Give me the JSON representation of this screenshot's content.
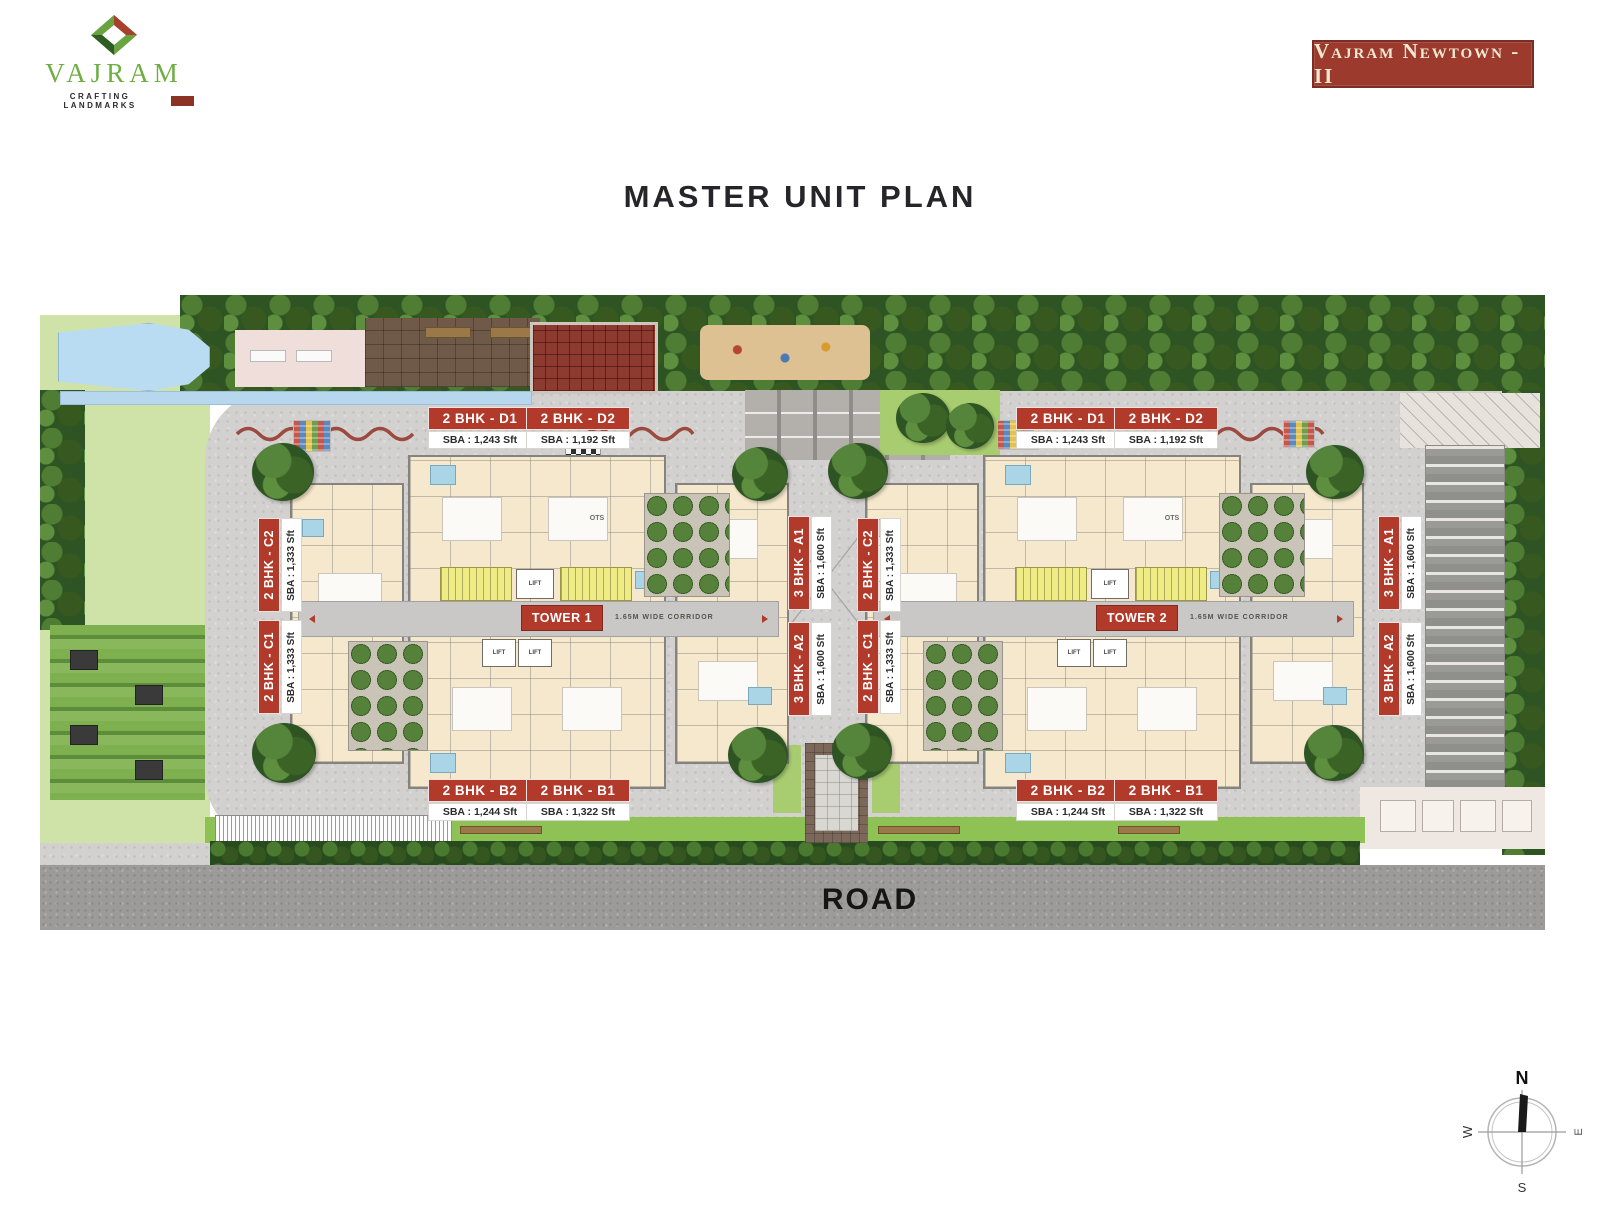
{
  "brand": {
    "name": "VAJRAM",
    "tagline": "CRAFTING LANDMARKS",
    "badge": "Vajram Newtown -II"
  },
  "title": "MASTER UNIT PLAN",
  "plan": {
    "towers": [
      {
        "name": "TOWER 1",
        "corridor": "1.65M WIDE CORRIDOR",
        "ots": "OTS",
        "lift": "LIFT",
        "units": {
          "top": [
            {
              "label": "2 BHK - D1",
              "sba": "SBA : 1,243 Sft"
            },
            {
              "label": "2 BHK - D2",
              "sba": "SBA : 1,192 Sft"
            }
          ],
          "bottom": [
            {
              "label": "2 BHK - B2",
              "sba": "SBA : 1,244 Sft"
            },
            {
              "label": "2 BHK - B1",
              "sba": "SBA : 1,322 Sft"
            }
          ],
          "left": [
            {
              "label": "2 BHK - C2",
              "sba": "SBA : 1,333 Sft"
            },
            {
              "label": "2 BHK - C1",
              "sba": "SBA : 1,333 Sft"
            }
          ],
          "right": [
            {
              "label": "3 BHK - A1",
              "sba": "SBA : 1,600 Sft"
            },
            {
              "label": "3 BHK - A2",
              "sba": "SBA : 1,600 Sft"
            }
          ]
        }
      },
      {
        "name": "TOWER 2",
        "corridor": "1.65M WIDE CORRIDOR",
        "ots": "OTS",
        "lift": "LIFT",
        "units": {
          "top": [
            {
              "label": "2 BHK - D1",
              "sba": "SBA : 1,243 Sft"
            },
            {
              "label": "2 BHK - D2",
              "sba": "SBA : 1,192 Sft"
            }
          ],
          "bottom": [
            {
              "label": "2 BHK - B2",
              "sba": "SBA : 1,244 Sft"
            },
            {
              "label": "2 BHK - B1",
              "sba": "SBA : 1,322 Sft"
            }
          ],
          "left": [
            {
              "label": "2 BHK - C2",
              "sba": "SBA : 1,333 Sft"
            },
            {
              "label": "2 BHK - C1",
              "sba": "SBA : 1,333 Sft"
            }
          ],
          "right": [
            {
              "label": "3 BHK - A1",
              "sba": "SBA : 1,600 Sft"
            },
            {
              "label": "3 BHK - A2",
              "sba": "SBA : 1,600 Sft"
            }
          ]
        }
      }
    ],
    "road": "ROAD",
    "compass": {
      "n": "N",
      "e": "E",
      "s": "S",
      "w": "W"
    }
  },
  "colors": {
    "label_red": "#b23a2a",
    "badge_red": "#9c3a2e",
    "logo_green": "#6fae44",
    "building_cream": "#f5e8cc",
    "stair_yellow": "#efec86",
    "bath_blue": "#aad5e7",
    "lawn_green": "#cfe3a9",
    "tree_green": "#2f5423",
    "compound_gray": "#d2d1d0",
    "road_gray": "#9c9b9a"
  }
}
